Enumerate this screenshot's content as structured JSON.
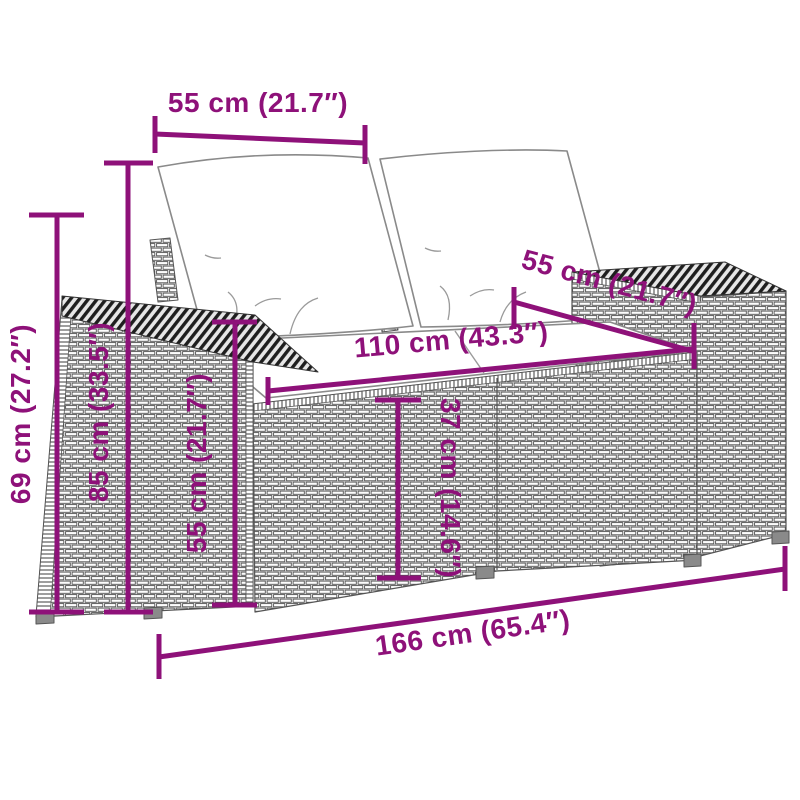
{
  "diagram": {
    "type": "product-dimension-diagram",
    "subject": "poly rattan 2-seater garden sofa with white cushions",
    "accent_color": "#8E1179",
    "outline_color": "#555555",
    "cushion_color": "#ffffff",
    "dims": {
      "cushion_width": {
        "name": "back cushion width",
        "value": "55 cm (21.7″)"
      },
      "overall_height": {
        "name": "overall height",
        "value": "69 cm (27.2″)"
      },
      "back_height": {
        "name": "backrest height",
        "value": "85 cm (33.5″)"
      },
      "arm_height": {
        "name": "armrest height",
        "value": "55 cm (21.7″)"
      },
      "seat_width": {
        "name": "seat width",
        "value": "110 cm (43.3″)"
      },
      "seat_depth": {
        "name": "seat depth",
        "value": "55 cm (21.7″)"
      },
      "seat_height": {
        "name": "seat height",
        "value": "37 cm (14.6″)"
      },
      "overall_width": {
        "name": "overall width",
        "value": "166 cm (65.4″)"
      }
    }
  }
}
